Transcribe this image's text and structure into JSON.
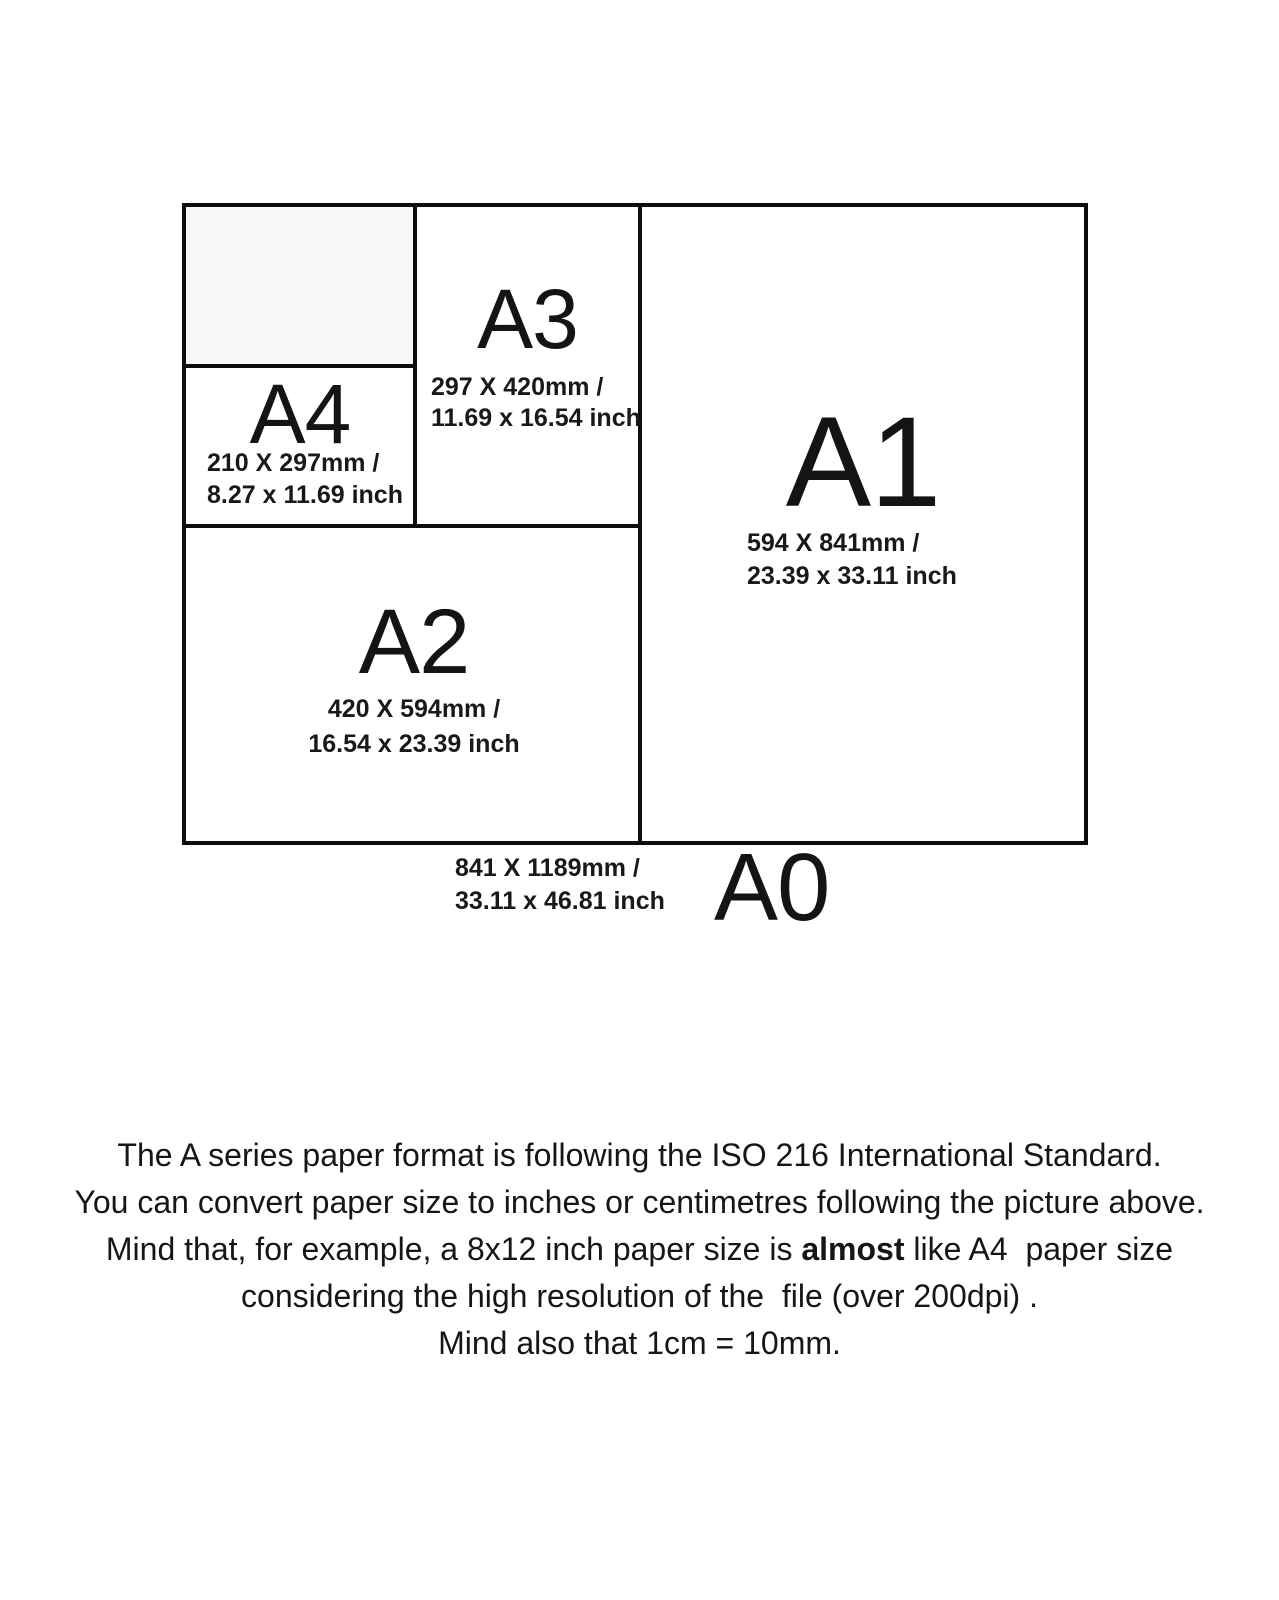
{
  "page": {
    "background": "#ffffff",
    "border_color": "#0d0d0d",
    "a5_fill_color": "#f7f7f7",
    "text_color": "#171717"
  },
  "diagram": {
    "sizes": {
      "a4": {
        "label": "A4",
        "mm": "210 X 297mm /",
        "inch": "8.27 x 11.69 inch"
      },
      "a3": {
        "label": "A3",
        "mm": "297 X 420mm /",
        "inch": "11.69 x 16.54 inch"
      },
      "a2": {
        "label": "A2",
        "mm": "420 X 594mm /",
        "inch": "16.54 x 23.39 inch"
      },
      "a1": {
        "label": "A1",
        "mm": "594 X 841mm /",
        "inch": "23.39 x 33.11 inch"
      },
      "a0": {
        "label": "A0",
        "mm": "841 X 1189mm /",
        "inch": "33.11 x 46.81 inch"
      }
    }
  },
  "caption": {
    "line1": "The A series paper format is following the ISO 216 International Standard.",
    "line2": "You can convert paper size to inches or centimetres following the picture above.",
    "line3_before": "Mind that, for example, a 8x12 inch paper size is ",
    "line3_bold": "almost",
    "line3_after": " like A4  paper size",
    "line4": "considering the high resolution of the  file (over 200dpi) .",
    "line5": "Mind also that 1cm = 10mm."
  }
}
